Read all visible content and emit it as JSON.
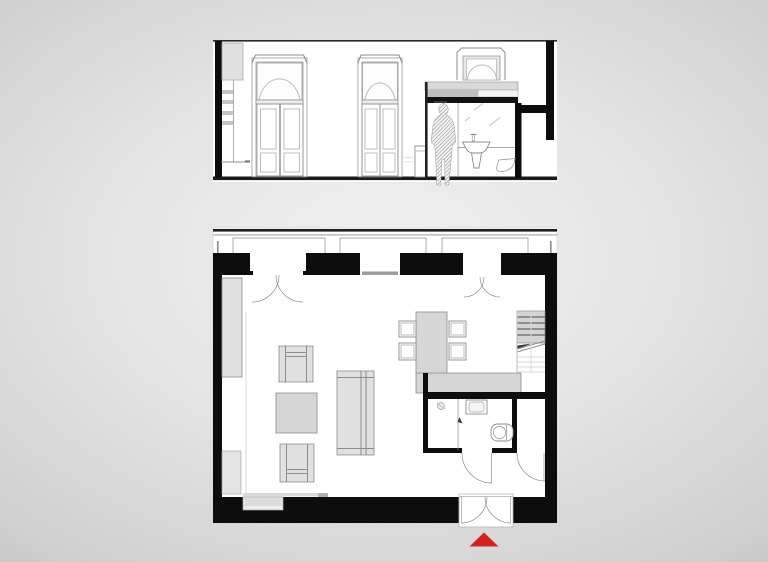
{
  "colors": {
    "canvas": "#ffffff",
    "wall": "#0d0d0d",
    "line": "#8c8c8c",
    "line_soft": "#bdbdbd",
    "line_dark": "#4a4a4a",
    "faint": "#d9d9d9",
    "furniture": "#e0e0e0",
    "furniture_deep": "#d6d6d6",
    "panel": "#c4c4c4",
    "accent": "#d6201d",
    "bg_center": "#f0f0f0",
    "bg_edge": "#a6a6a6"
  },
  "drawings": {
    "section_elevation": {
      "type": "architectural-section",
      "features": [
        "shelf-wall",
        "arched-french-door",
        "arched-french-door",
        "console-cabinet",
        "bathroom-volume",
        "person-figure",
        "washbasin",
        "mirror",
        "toilet",
        "arched-window"
      ]
    },
    "floor_plan": {
      "type": "architectural-floor-plan",
      "features": [
        "balcony-strip",
        "double-french-doors",
        "window",
        "wardrobe",
        "armchairs",
        "coffee-table",
        "sofa",
        "dining-table-with-chairs",
        "kitchen-counter",
        "staircase",
        "bathroom-with-shower-sink-toilet",
        "entrance-double-door",
        "fireplace-recess"
      ]
    },
    "entry_marker": {
      "shape": "triangle",
      "direction": "up"
    }
  }
}
